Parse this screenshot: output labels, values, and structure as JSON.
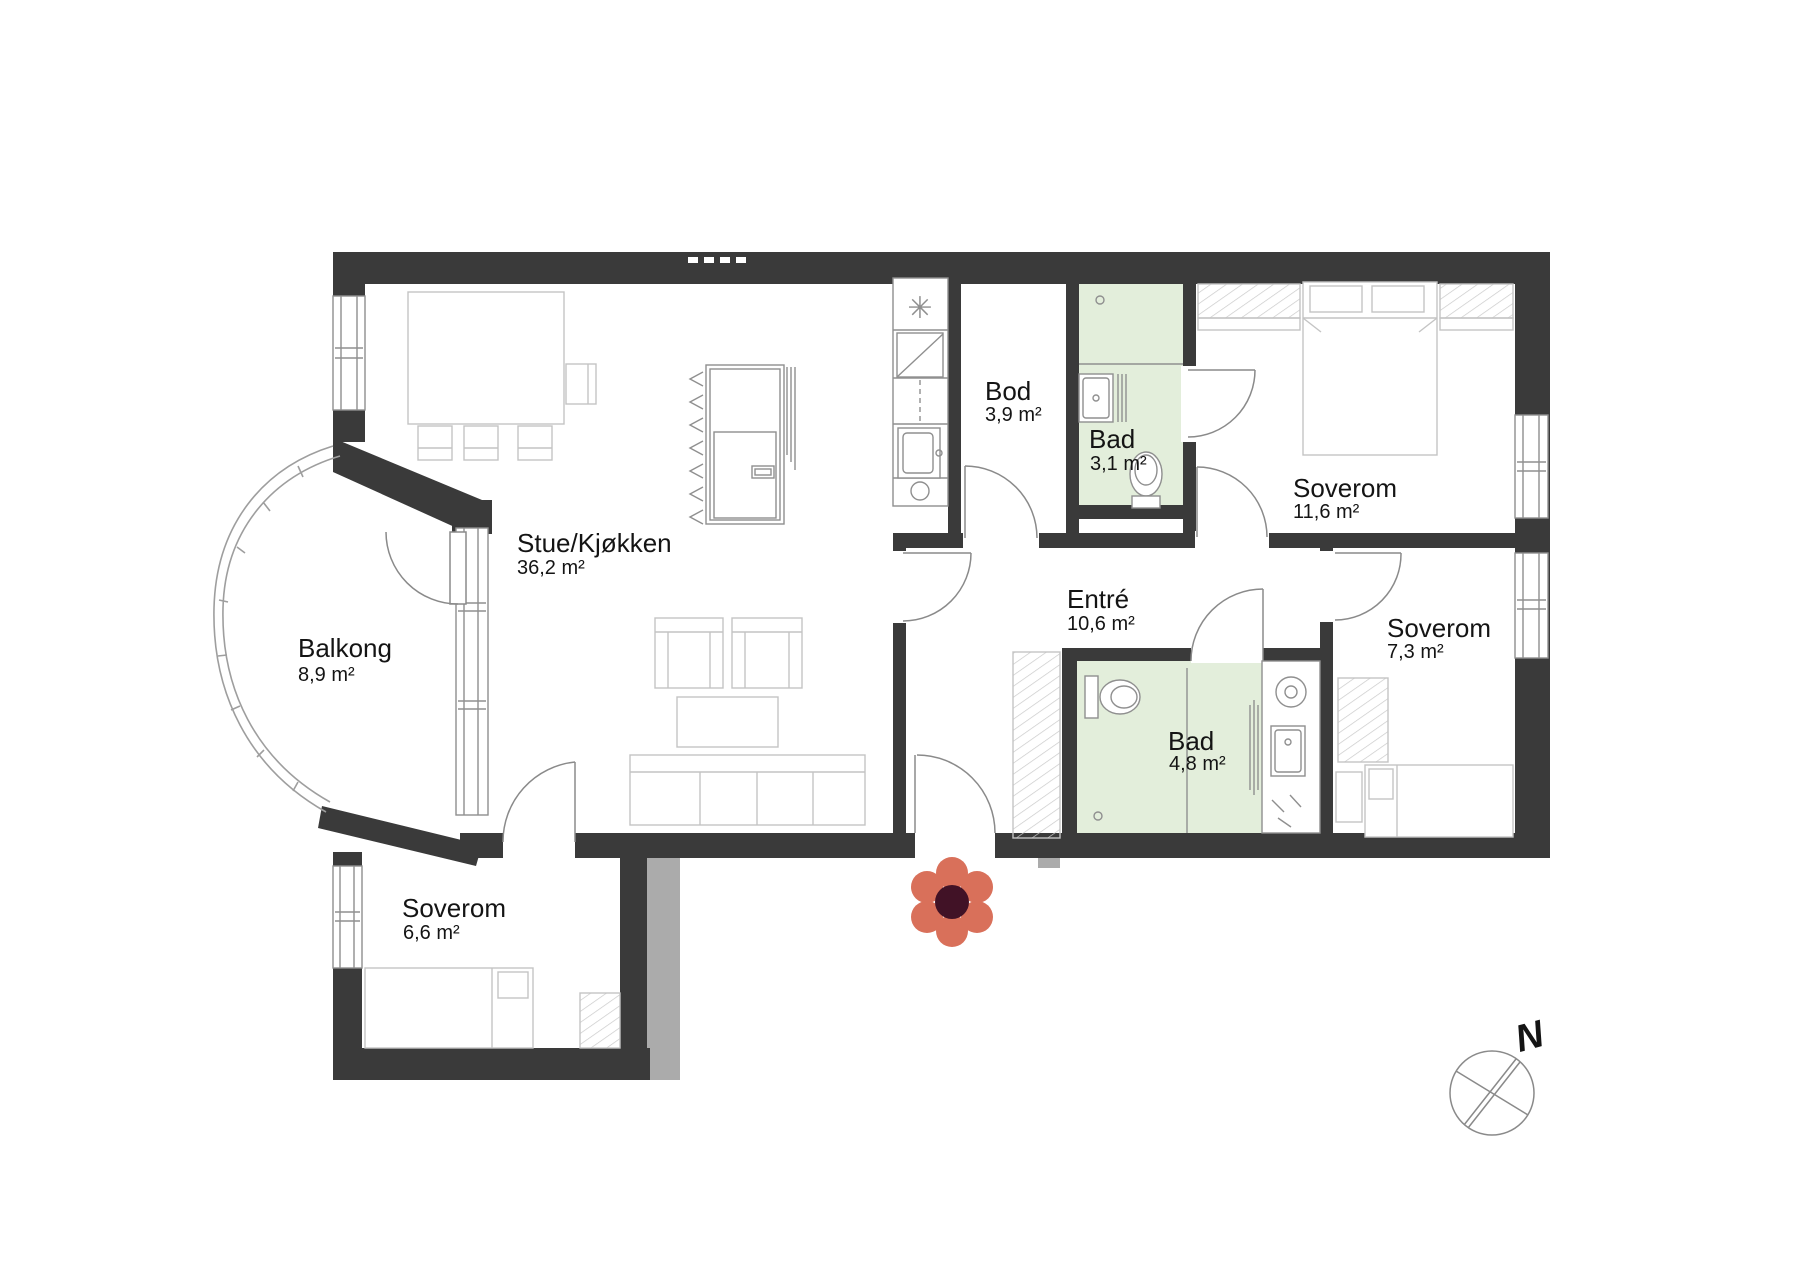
{
  "rooms": [
    {
      "id": "stue-kjokken",
      "name": "Stue/Kjøkken",
      "area": "36,2 m²"
    },
    {
      "id": "balkong",
      "name": "Balkong",
      "area": "8,9 m²"
    },
    {
      "id": "bod",
      "name": "Bod",
      "area": "3,9 m²"
    },
    {
      "id": "bad-1",
      "name": "Bad",
      "area": "3,1 m²"
    },
    {
      "id": "soverom-1",
      "name": "Soverom",
      "area": "11,6 m²"
    },
    {
      "id": "entre",
      "name": "Entré",
      "area": "10,6 m²"
    },
    {
      "id": "bad-2",
      "name": "Bad",
      "area": "4,8 m²"
    },
    {
      "id": "soverom-2",
      "name": "Soverom",
      "area": "7,3 m²"
    },
    {
      "id": "soverom-3",
      "name": "Soverom",
      "area": "6,6 m²"
    }
  ],
  "compass": {
    "label": "N"
  },
  "icons": {
    "stove_symbol": "✳"
  },
  "colors": {
    "background": "#ffffff",
    "wall": "#3a3a3a",
    "neighbor_wall": "#ababab",
    "bathroom_fill": "#e3eedb",
    "fixture_line": "#8f8f8f",
    "furniture_line": "#c4c4c4",
    "door_line": "#8a8a8a",
    "railing_line": "#9e9e9e",
    "hatch_line": "#c9c9c9",
    "text": "#141414",
    "flower_petal": "#d9705a",
    "flower_center": "#411226",
    "compass_line": "#8a8a8a"
  }
}
